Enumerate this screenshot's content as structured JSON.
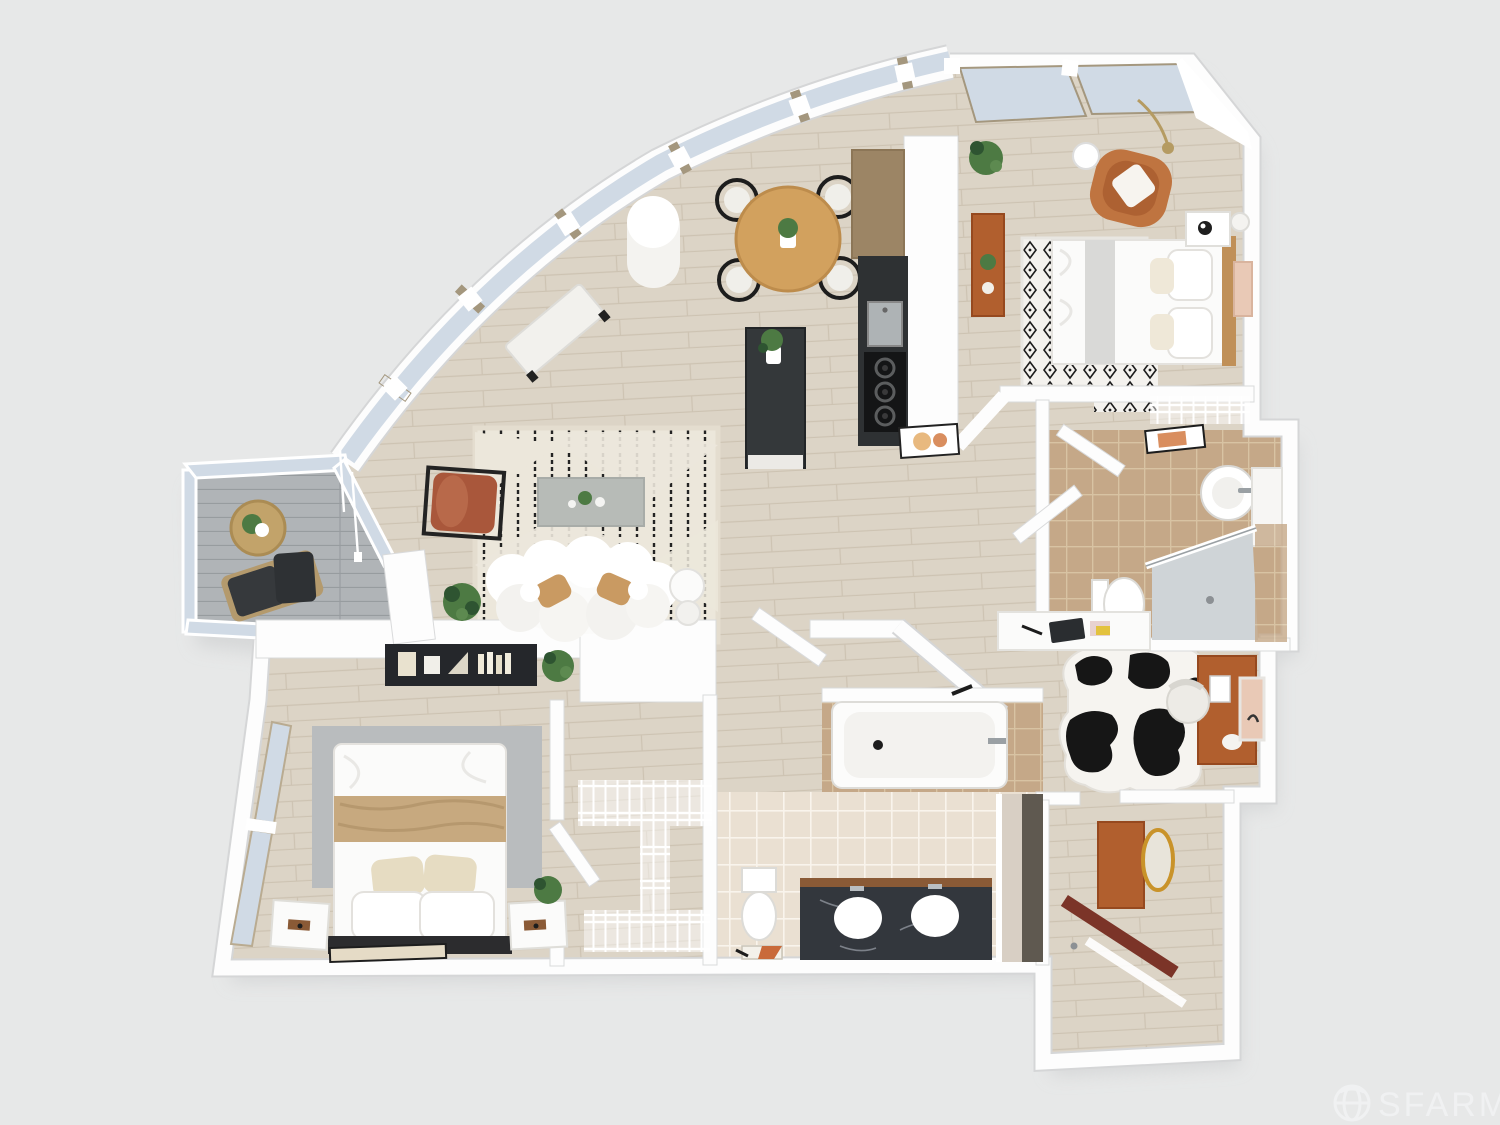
{
  "watermark": {
    "label": "SFARMLS",
    "icon": "globe-icon"
  },
  "scene": {
    "type": "3d-top-down-floor-plan",
    "rooms": [
      "living-room",
      "dining-area",
      "kitchen",
      "bedroom-primary-top-right",
      "bedroom-second-bottom-left",
      "primary-bathroom",
      "second-bathroom",
      "walk-in-closet",
      "hall-closet",
      "office-den",
      "entry-hall",
      "balcony"
    ]
  },
  "palette": {
    "background": "#e7e8e8",
    "wall": "#fdfdfd",
    "floor-wood": "#dcd4c6",
    "floor-wood-line": "#cdc3b2",
    "tile-cream": "#eae0d2",
    "tile-tan": "#c5a888",
    "deck": "#b0b4b7",
    "deck-line": "#979c9f",
    "glass": "#d0dae5",
    "mullion": "#a4977e",
    "counter-dark": "#2e3133",
    "island-dark": "#34383a",
    "marble-dark": "#33373d",
    "wood-accent": "#c09058",
    "desk-wood": "#b15f2e",
    "terracotta": "#a9573b",
    "tan-pillow": "#c99a62",
    "rug-cream": "#ece7db",
    "rug-gray": "#b9bcbe",
    "plant-green": "#4d7a43",
    "door-brown": "#7b3428",
    "mirror-gold": "#c9932a",
    "blush-art": "#e9c9b6"
  }
}
